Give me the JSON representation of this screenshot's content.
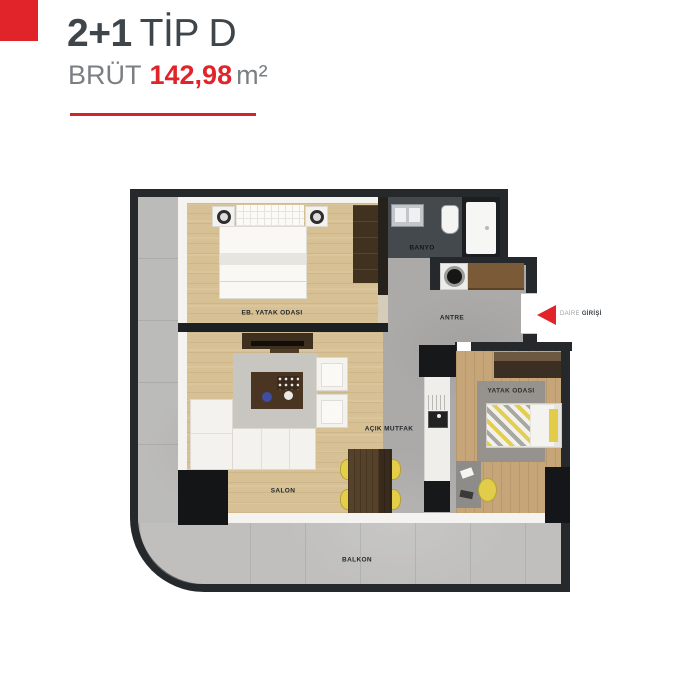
{
  "header": {
    "title_bold": "2+1",
    "title_light": "TİP D",
    "area_label": "BRÜT",
    "area_value": "142,98",
    "area_unit": "m²"
  },
  "plan": {
    "rooms": {
      "master_bedroom": "EB. YATAK ODASI",
      "bathroom": "BANYO",
      "entry_hall": "ANTRE",
      "living_room": "SALON",
      "open_kitchen": "AÇIK MUTFAK",
      "bedroom": "YATAK ODASI",
      "balcony": "BALKON"
    },
    "entrance": {
      "label_light": "DAİRE",
      "label_bold": "GİRİŞİ"
    }
  },
  "colors": {
    "accent_red": "#e0242a",
    "heading_dark": "#3e454b",
    "heading_gray": "#7a7f84",
    "wall_dark": "#26292c",
    "wood_light": "#d7c094",
    "wood_warm": "#c6a678",
    "concrete_gray": "#abaaa8",
    "yellow_accent": "#e3cd49",
    "label_dark": "#23282c"
  }
}
